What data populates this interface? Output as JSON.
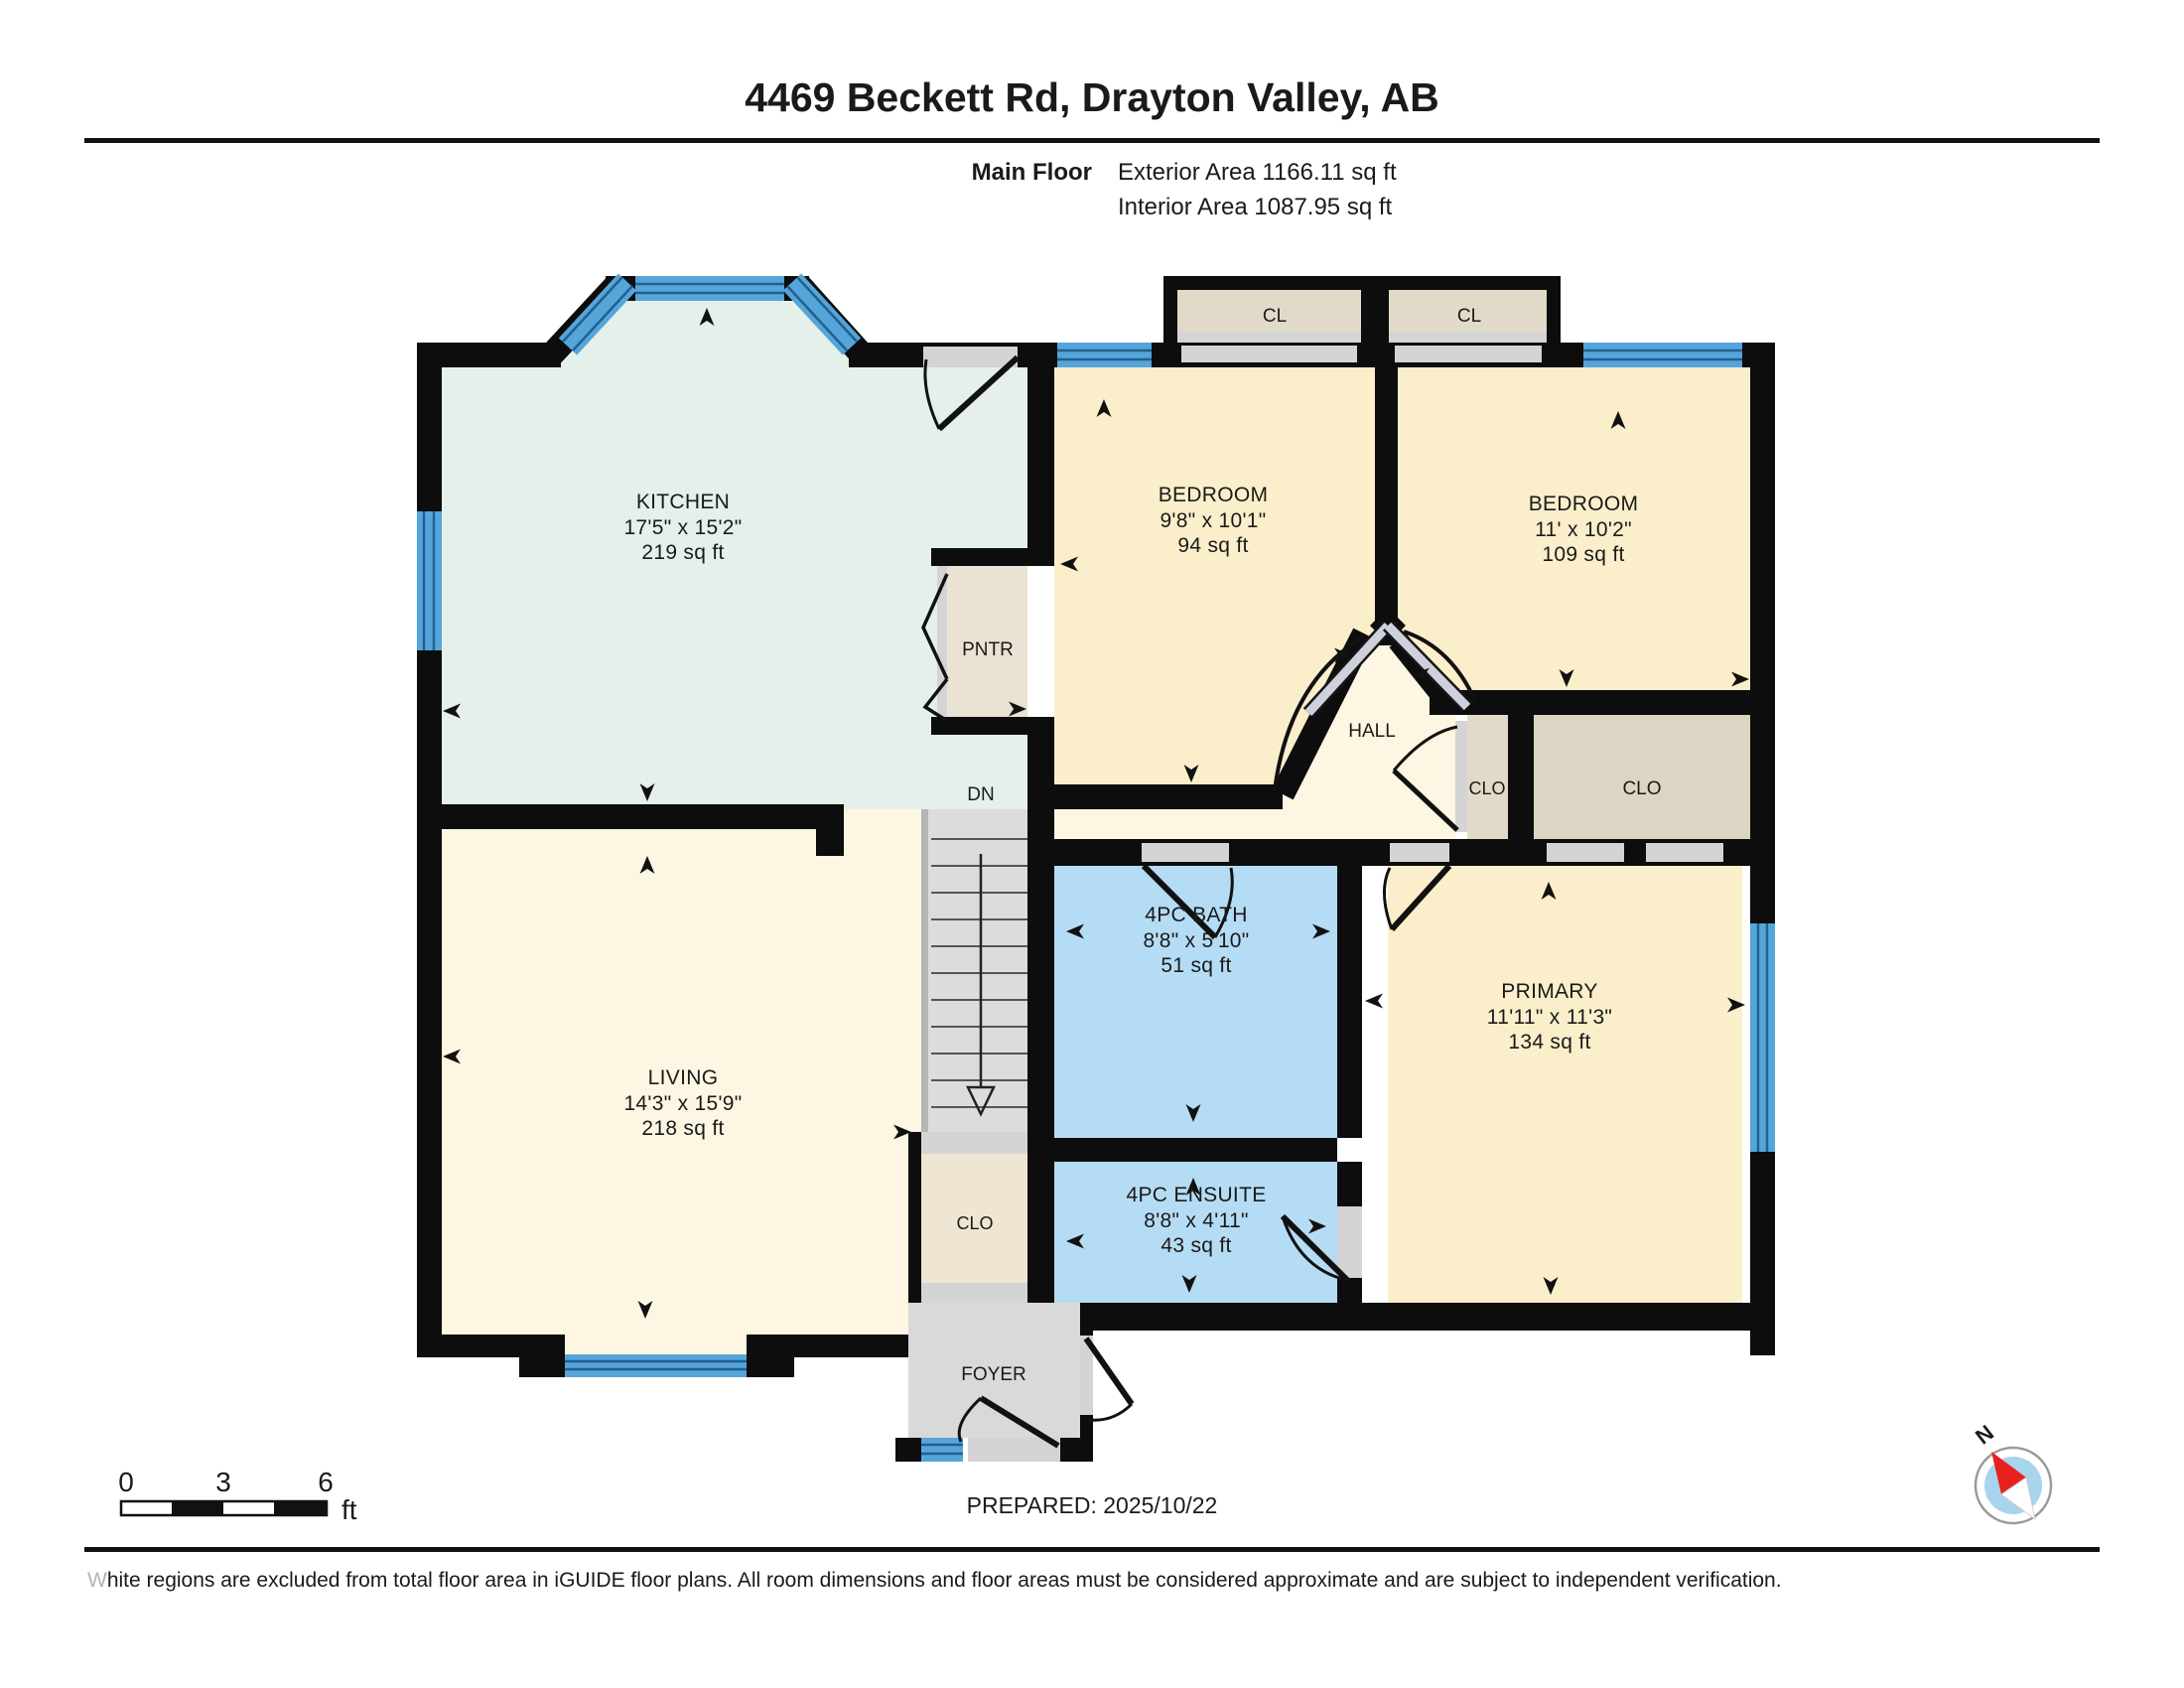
{
  "header": {
    "title": "4469 Beckett Rd, Drayton Valley, AB",
    "floor_label": "Main Floor",
    "exterior_area": "Exterior Area 1166.11 sq ft",
    "interior_area": "Interior Area 1087.95 sq ft"
  },
  "rooms": {
    "kitchen": {
      "name": "KITCHEN",
      "dims": "17'5\" x 15'2\"",
      "area": "219 sq ft"
    },
    "bedroom1": {
      "name": "BEDROOM",
      "dims": "9'8\" x 10'1\"",
      "area": "94 sq ft"
    },
    "bedroom2": {
      "name": "BEDROOM",
      "dims": "11' x 10'2\"",
      "area": "109 sq ft"
    },
    "bath": {
      "name": "4PC BATH",
      "dims": "8'8\" x 5'10\"",
      "area": "51 sq ft"
    },
    "ensuite": {
      "name": "4PC ENSUITE",
      "dims": "8'8\" x 4'11\"",
      "area": "43 sq ft"
    },
    "primary": {
      "name": "PRIMARY",
      "dims": "11'11\" x 11'3\"",
      "area": "134 sq ft"
    },
    "living": {
      "name": "LIVING",
      "dims": "14'3\" x 15'9\"",
      "area": "218 sq ft"
    },
    "hall": {
      "name": "HALL"
    },
    "pantry": {
      "name": "PNTR"
    },
    "closet_cl1": {
      "name": "CL"
    },
    "closet_cl2": {
      "name": "CL"
    },
    "closet_hall": {
      "name": "CLO"
    },
    "closet_bedroom": {
      "name": "CLO"
    },
    "closet_stairs": {
      "name": "CLO"
    },
    "foyer": {
      "name": "FOYER"
    },
    "stairs": {
      "name": "DN"
    }
  },
  "scale_bar": {
    "tick0": "0",
    "tick1": "3",
    "tick2": "6",
    "unit": "ft"
  },
  "prepared": "PREPARED: 2025/10/22",
  "compass": {
    "label": "N"
  },
  "disclaimer": {
    "first_letter": "W",
    "rest": "hite regions are excluded from total floor area in iGUIDE floor plans. All room dimensions and floor areas must be considered approximate and are subject to independent verification."
  },
  "colors": {
    "wall": "#0d0d0d",
    "window_blue": "#55a5da",
    "window_line": "#21608f",
    "room_yellow": "#fbeecb",
    "room_cream": "#fdf6e2",
    "kitchen_green": "#e4f0e9",
    "bath_blue": "#b5dcf5",
    "closet_tan": "#e6ddcb",
    "closet_dark_tan": "#ddd5c3",
    "pantry_tan": "#eae2d2",
    "opening_gray": "#d4d4d4",
    "stairs_gray": "#dcdcdc",
    "foyer_gray": "#d9d9d9"
  }
}
